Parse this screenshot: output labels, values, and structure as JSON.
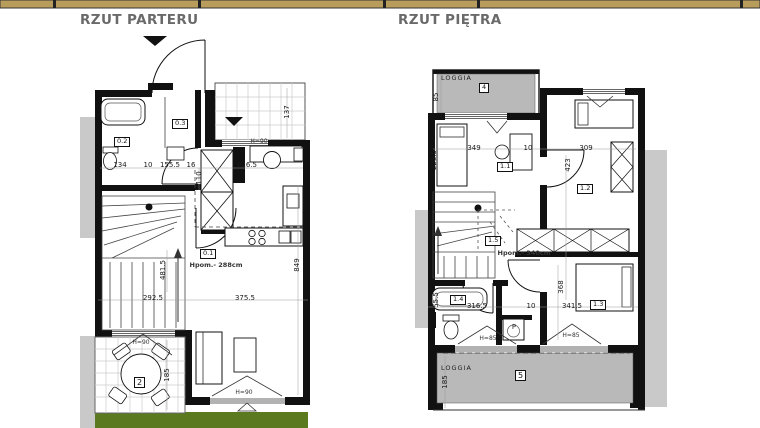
{
  "titles": {
    "parter": "RZUT PARTERU",
    "pietro": "RZUT PIĘTRA"
  },
  "colors": {
    "bar": "#b89c5c",
    "loggia": "#b9b9b9",
    "neighbor": "#c9c9c9",
    "grass": "#5b7a1f"
  },
  "parter": {
    "rooms": {
      "r01": "0.1",
      "r02": "0.2",
      "r03": "0.3",
      "terrace": "2"
    },
    "note": "Hpom.- 288cm",
    "dims": {
      "bath_w": "134",
      "g1": "10",
      "hall_w": "155.5",
      "g2": "16",
      "study_w": "326.5",
      "hall_d": "110",
      "porch_d": "137",
      "stair_h": "481.5",
      "living_h": "849",
      "living_w1": "292.5",
      "living_w2": "375.5",
      "terrace_h": "185"
    },
    "windows": {
      "study": "H=90",
      "terrace_door": "H=90",
      "living": "H=90"
    }
  },
  "pietro": {
    "loggia_top": {
      "label": "LOGGIA",
      "num": "4",
      "depth": "85"
    },
    "loggia_bottom": {
      "label": "LOGGIA",
      "num": "5",
      "depth": "185"
    },
    "rooms": {
      "r11": "1.1",
      "r12": "1.2",
      "r13": "1.3",
      "r14": "1.4",
      "r15": "1.5"
    },
    "note": "Hpom.- 340cm",
    "dims": {
      "bed1_h": "228.5",
      "bed1_w": "349",
      "g1": "10",
      "bed2_w": "309",
      "hall_h": "423",
      "bath_w": "316.5",
      "g2": "10",
      "bed3_w": "341.5",
      "bed3_h": "368",
      "nook": "55.5"
    },
    "windows": {
      "w1": "H=85",
      "w2": "H=85"
    },
    "washer": "P"
  }
}
